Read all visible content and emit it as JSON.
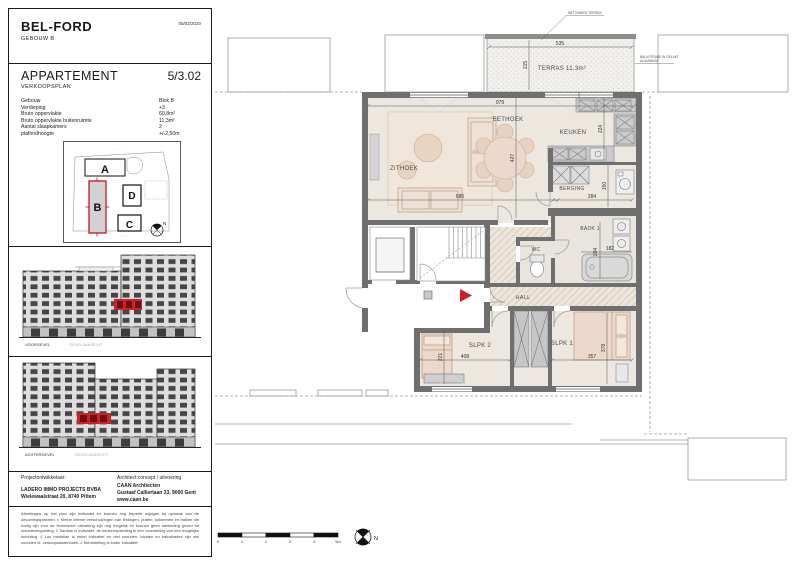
{
  "document": {
    "project": "BEL-FORD",
    "building": "GEBOUW B",
    "date": "05/02/2020",
    "title": "APPARTEMENT",
    "unit": "5/3.02",
    "subtitle": "VERKOOPSPLAN"
  },
  "specs": [
    {
      "label": "Gebouw",
      "value": "Blok B"
    },
    {
      "label": "Verdieping",
      "value": "+3"
    },
    {
      "label": "Bruto oppervlakte",
      "value": "60,8m²"
    },
    {
      "label": "Bruto oppervlakte buitenruimte",
      "value": "11,3m²"
    },
    {
      "label": "Aantal slaapkamers",
      "value": "2"
    },
    {
      "label": "plafondhoogte",
      "value": "+/-2,50m"
    }
  ],
  "site_plan": {
    "blocks": {
      "a": "A",
      "b": "B",
      "c": "C",
      "d": "D"
    },
    "highlighted_block": "B",
    "north": "N",
    "street_top": "·········",
    "street_left": "·········",
    "street_bottom": "···········"
  },
  "elevations": [
    {
      "caption": "VOORGEVEL",
      "note": "GEVELAANZICHT"
    },
    {
      "caption": "ACHTERGEVEL",
      "note": "GEVELAANZICHT"
    }
  ],
  "footer": {
    "developer_label": "Projectontwikkelaar:",
    "developer_name": "LADERO IMMO PROJECTS BVBA",
    "developer_address": "Wielewaalstraat 20, 8740 Pittem",
    "architect_label": "Architect concept / uitvoering",
    "architect_name": "CAAN Architecten",
    "architect_address": "Gustaaf Callierlaan 33, 9000 Gent",
    "architect_website": "www.caan.be"
  },
  "disclaimer": "Afmetingen op het plan zijn indicatief en kunnen nog beperkt wijzigen bij opmaak van de uitvoeringsplannen.  //  Kleine interne verschuivingen van leidingen, putten, kolommen en balken die nodig zijn voor de technische uitvoering zijn nog mogelijk en kunnen geen aanleiding geven tot schadevergoeding.  //  Sanitair is indicatief, de keukenopstelling is een voorstelling van een mogelijke inrichting.  //  Los meubilair is enkel indicatief en niet voorzien, lokalen en balustrades zijn wel voorzien cf. verkoopslastenboek.  //  Kleurstelling is louter indicatief.",
  "plan": {
    "rooms": {
      "terras": "TERRAS 11,3m²",
      "zithoek": "ZITHOEK",
      "eethoek": "EETHOEK",
      "keuken": "KEUKEN",
      "berging": "BERGING",
      "badk": "BADK 1",
      "wc": "WC",
      "hall": "HALL",
      "slpk1": "SLPK 1",
      "slpk2": "SLPK 2"
    },
    "dims": {
      "total_width": "979",
      "zithoek_width": "685",
      "living_depth": "427",
      "terras_width": "535",
      "terras_depth": "215",
      "keuken_depth": "224",
      "berging_width": "284",
      "berging_depth": "150",
      "badk_depth": "204",
      "badk_width": "182",
      "slpk2_width": "408",
      "slpk2_depth": "221",
      "slpk1_width": "357",
      "slpk1_depth": "378"
    },
    "annotations": {
      "terrace": "BETONNEN TERRAS",
      "balustrade_1": "BALUSTRADE IN GELAKT",
      "balustrade_2": "ALUMINIUM"
    },
    "scale": [
      "0",
      "1",
      "2",
      "3",
      "4",
      "5m"
    ],
    "north": "N"
  },
  "colors": {
    "accent_red": "#cc2127",
    "wall_gray": "#6f6f6f"
  }
}
